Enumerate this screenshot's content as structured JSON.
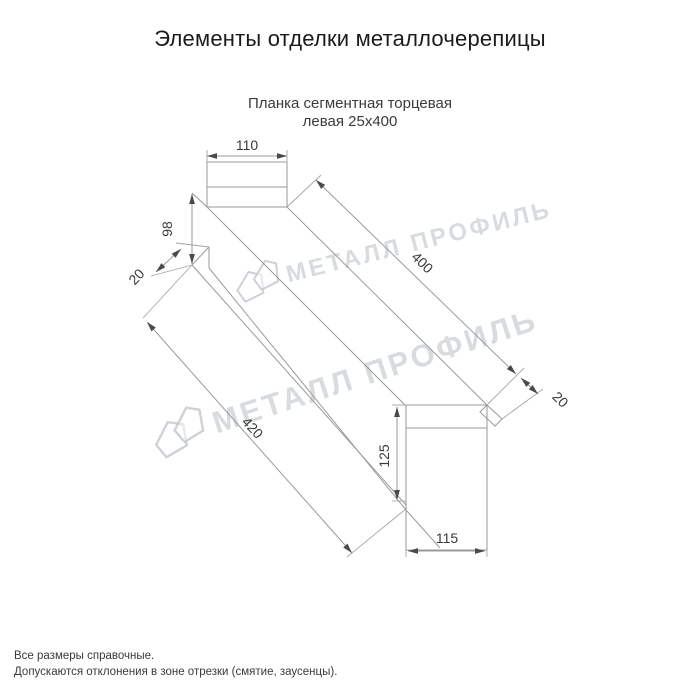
{
  "page": {
    "title": "Элементы отделки металлочерепицы",
    "subtitle_line1": "Планка сегментная торцевая",
    "subtitle_line2": "левая 25х400",
    "footer_line1": "Все размеры справочные.",
    "footer_line2": "Допускаются отклонения в зоне отрезки (смятие, заусенцы)."
  },
  "watermark": {
    "text": "МЕТАЛЛ ПРОФИЛЬ",
    "logo": "metall-profil-roof-logo",
    "color": "#d2d6da"
  },
  "drawing": {
    "name": "Планка сегментная торцевая левая 25х400",
    "line_color": "#9a9a9a",
    "dim_text_color": "#3a3a3a",
    "dimensions": {
      "top_width": "110",
      "left_height": "98",
      "left_hem": "20",
      "length_top": "400",
      "length_bottom": "420",
      "right_hem": "20",
      "end_height": "125",
      "end_width": "115"
    }
  }
}
